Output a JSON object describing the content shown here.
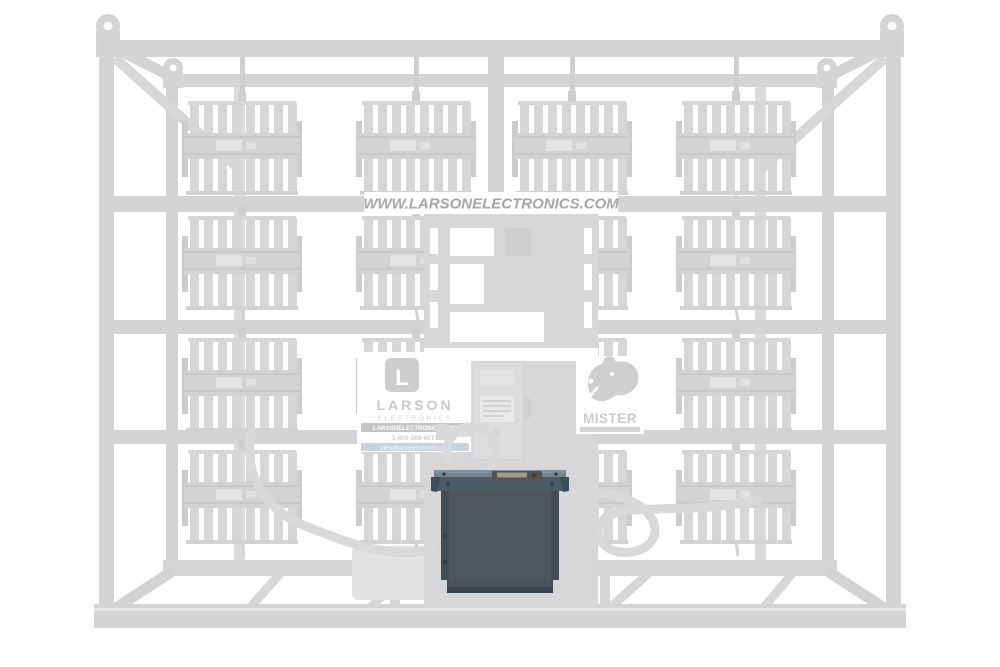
{
  "photo": {
    "description": "Ghosted product photo of a Larson Electronics skid-mounted LED light tower frame with the transformer junction box highlighted in dark gray",
    "floodlight_rows": 4,
    "floodlight_columns": 4
  },
  "banner": {
    "url_text": "WWW.LARSONELECTRONICS.COM"
  },
  "larson_placard": {
    "logo_letter": "L",
    "brand": "LARSON",
    "sub_brand": "ELECTRONICS",
    "website": "LARSONELECTRONICS.COM",
    "phone": "1-800-369-6671",
    "email": "sales@larsonelectronics.com"
  },
  "mister_placard": {
    "brand": "MISTER"
  },
  "colors": {
    "background": "#ffffff",
    "ghost_frame": "#d3d3d5",
    "ghost_light": "#d7d7d9",
    "ghost_text": "#a6a6a8",
    "transformer_body": "#4f575e",
    "transformer_lid_top": "#75848b",
    "transformer_lid_edge": "#4d5c64",
    "transformer_label": "#a2988c"
  }
}
